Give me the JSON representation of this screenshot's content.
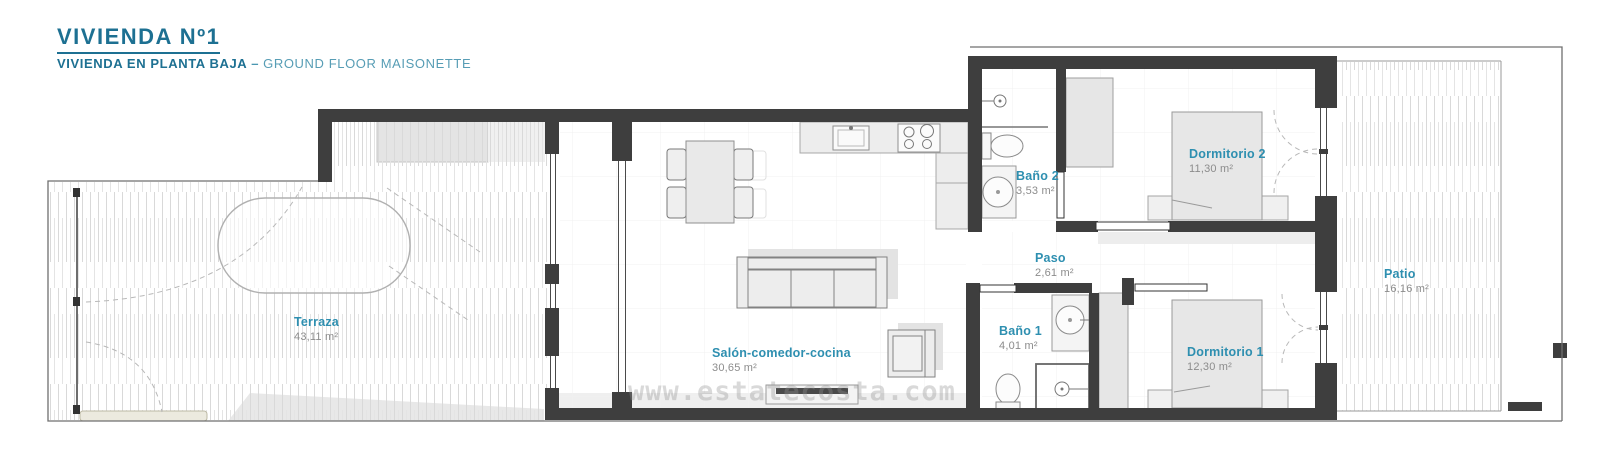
{
  "header": {
    "title": "VIVIENDA Nº1",
    "subtitle_es": "VIVIENDA EN PLANTA BAJA",
    "subtitle_dash": "–",
    "subtitle_en": "GROUND FLOOR MAISONETTE"
  },
  "watermark": "www.estatecosta.com",
  "colors": {
    "title_teal": "#1d7092",
    "subtitle_light_teal": "#579db5",
    "room_label_teal": "#2e8fb0",
    "area_text_gray": "#8c8c8c",
    "wall_dark": "#3e3e3e",
    "furniture_fill": "#ededed",
    "hatch_gray": "#d9d9d9"
  },
  "rooms": [
    {
      "id": "terraza",
      "name": "Terraza",
      "area": "43,11 m²"
    },
    {
      "id": "salon",
      "name": "Salón-comedor-cocina",
      "area": "30,65 m²"
    },
    {
      "id": "bano2",
      "name": "Baño 2",
      "area": "3,53 m²"
    },
    {
      "id": "dormitorio2",
      "name": "Dormitorio 2",
      "area": "11,30 m²"
    },
    {
      "id": "paso",
      "name": "Paso",
      "area": "2,61 m²"
    },
    {
      "id": "bano1",
      "name": "Baño 1",
      "area": "4,01 m²"
    },
    {
      "id": "dormitorio1",
      "name": "Dormitorio 1",
      "area": "12,30 m²"
    },
    {
      "id": "patio",
      "name": "Patio",
      "area": "16,16 m²"
    }
  ]
}
